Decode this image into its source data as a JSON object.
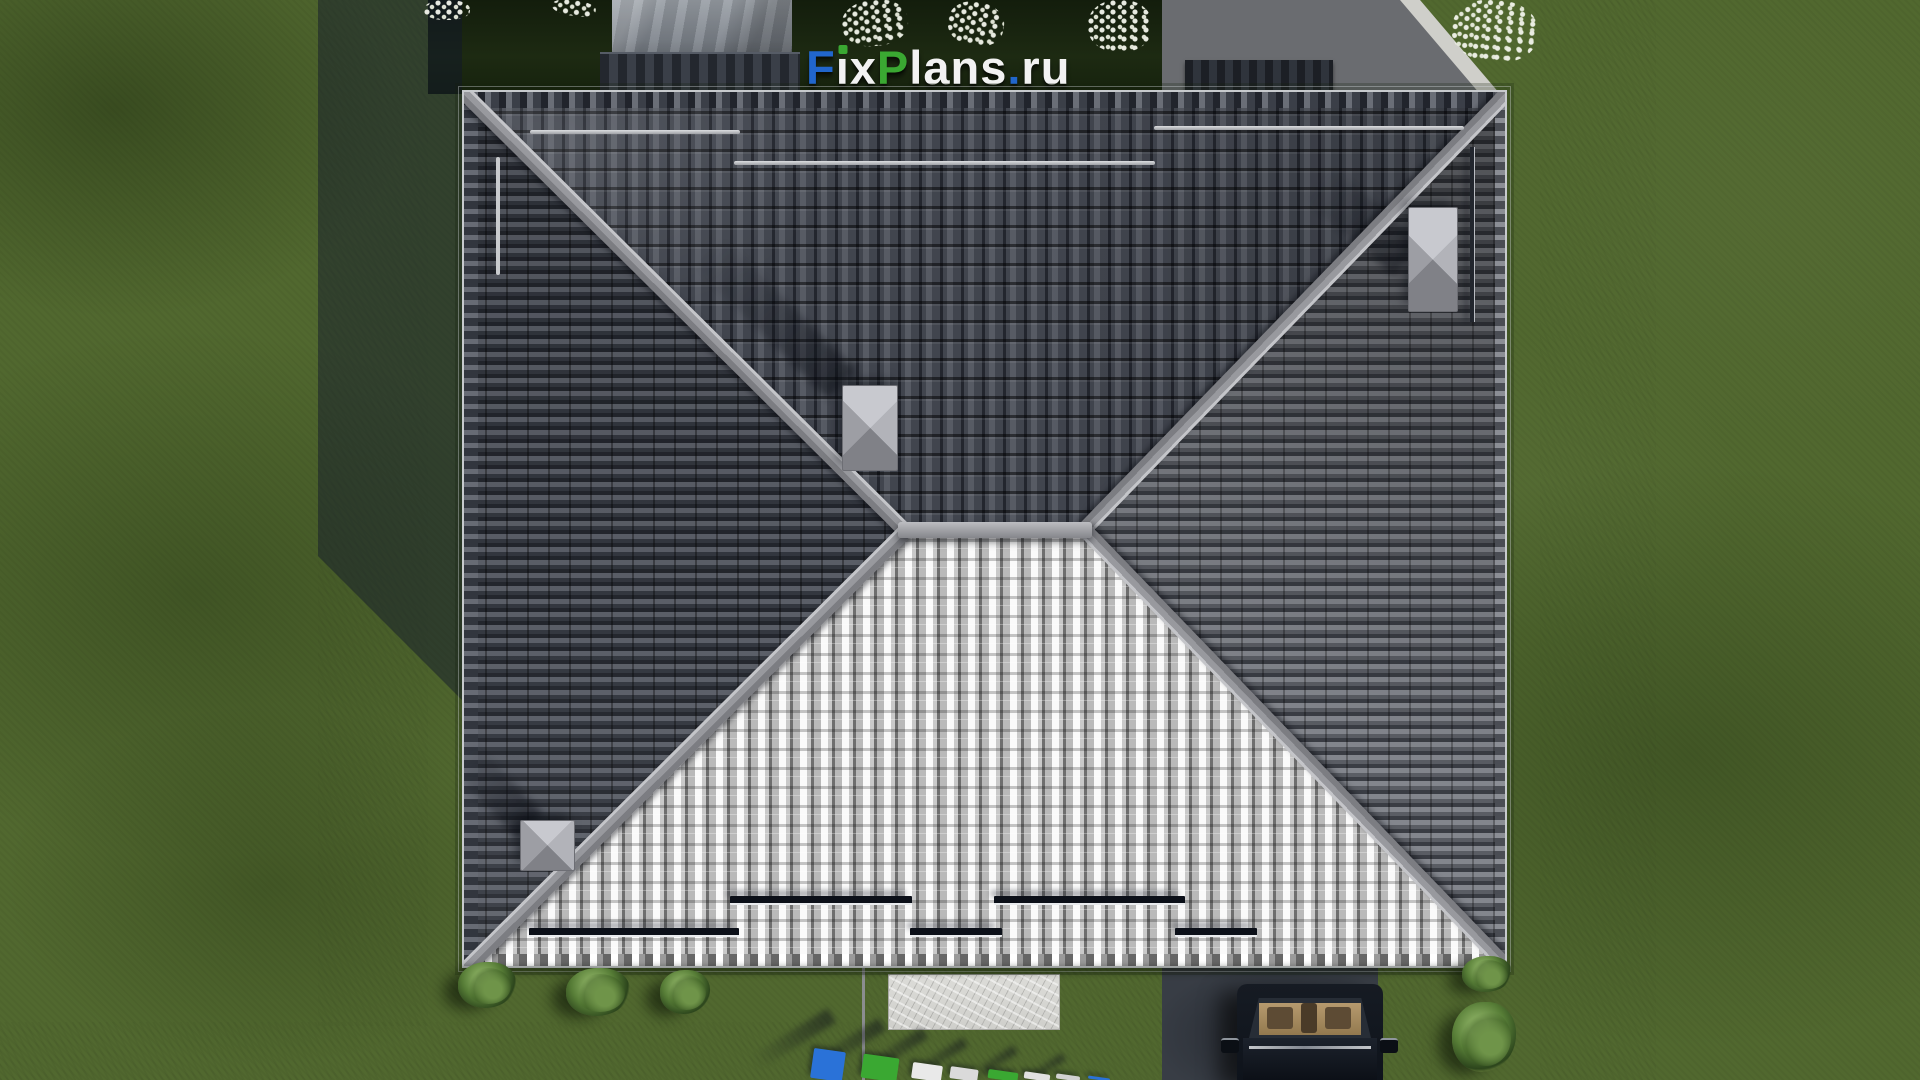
{
  "watermark_top": {
    "text": "FixPlans.ru",
    "segments": [
      {
        "letter": "F",
        "color": "#2166cc"
      },
      {
        "letter": "i",
        "color": "#f2f2f2",
        "dot_color": "#3aa832"
      },
      {
        "letter": "x",
        "color": "#f2f2f2"
      },
      {
        "letter": "P",
        "color": "#3aa832"
      },
      {
        "letter": "l",
        "color": "#f2f2f2"
      },
      {
        "letter": "a",
        "color": "#f2f2f2"
      },
      {
        "letter": "n",
        "color": "#f2f2f2"
      },
      {
        "letter": "s",
        "color": "#f2f2f2"
      },
      {
        "letter": ".",
        "color": "#2166cc"
      },
      {
        "letter": "r",
        "color": "#f2f2f2"
      },
      {
        "letter": "u",
        "color": "#f2f2f2"
      }
    ]
  },
  "watermark_bottom": {
    "text": "FixPlans.ru",
    "state": "3D letters cut off at bottom edge, only tops visible",
    "block_colors": [
      "#2a72d8",
      "#3aa832",
      "#e9e9e9",
      "#dadada",
      "#3aa832",
      "#e0e0e0",
      "#d2d2d2",
      "#2a72d8"
    ]
  },
  "scene": {
    "type": "aerial top-down 3D architectural render",
    "house": {
      "roof": "rectangular hip roof with barrel tiles",
      "faces": [
        "north face dark",
        "south face sunlit white",
        "west face shaded",
        "east face lit gray"
      ],
      "roof_vents": 3,
      "snow_guards": "staggered bars on all four slopes"
    },
    "grounds": {
      "lawn": "green grass with mottled patches",
      "paths": "light concrete walkways on left, right and bottom",
      "driveway": "dark paving with parked car, bottom right",
      "entrance": "concrete pad with textured stone mat, bottom center",
      "shrubs": "low green bushes along south wall and near driveway",
      "flowers": "white flower clusters along the top edge",
      "fence": "dark ribbed fence segments and stone structure behind house"
    },
    "vehicle": {
      "type": "car seen from above, front toward camera",
      "body_color": "#10151d",
      "interior_color": "#b29469"
    }
  },
  "colors": {
    "grass": "#51682f",
    "grass_shadow": "#18220f",
    "path_light": "#cbcbc7",
    "path_shadowed": "#9095a5",
    "roof_north": "#41454e",
    "roof_south_highlight": "#fafafa",
    "roof_east": "#6e7178",
    "roof_west": "#3a3e47",
    "ridge": "#a3a4a8",
    "brand_blue": "#2166cc",
    "brand_green": "#3aa832"
  }
}
